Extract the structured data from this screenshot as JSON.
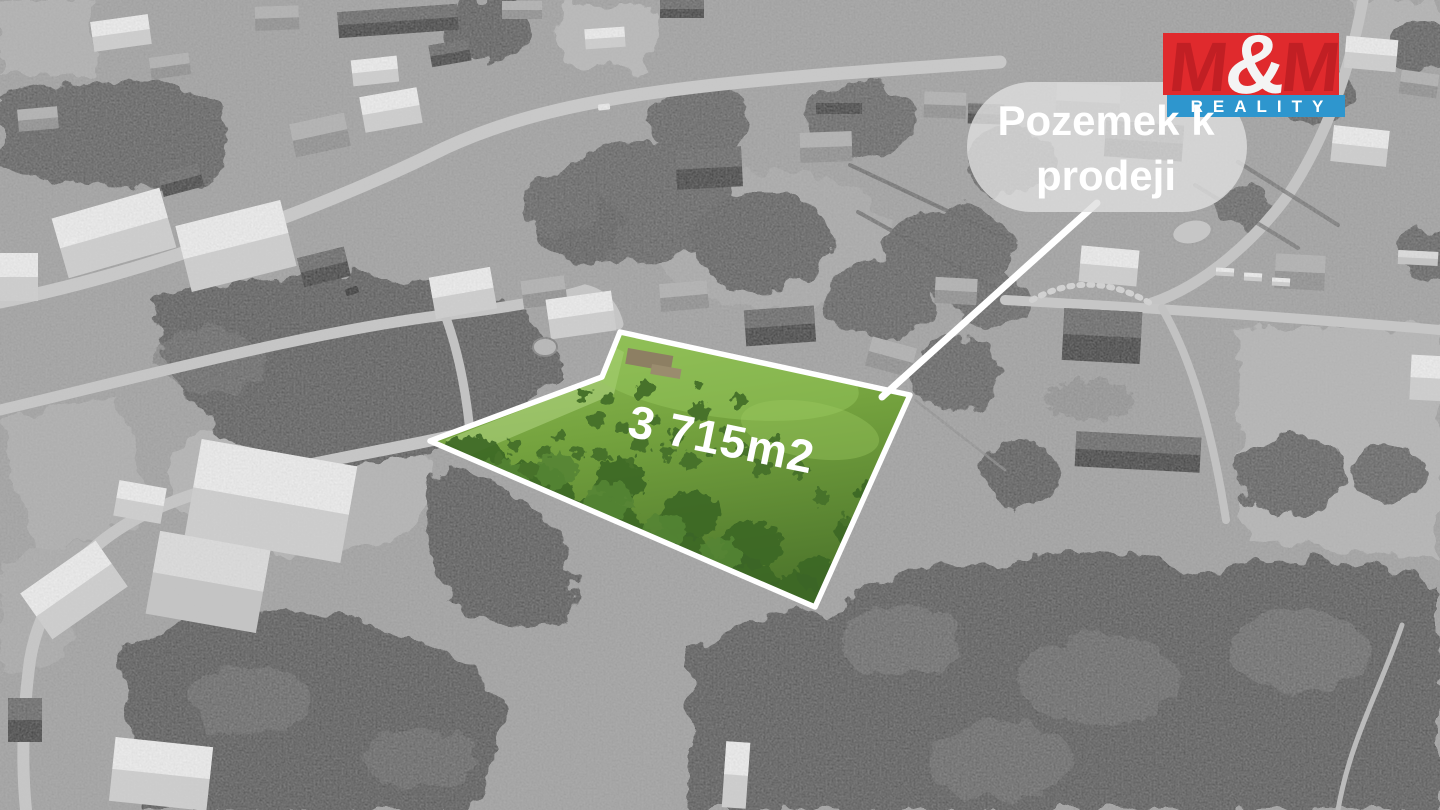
{
  "callout": {
    "line1": "Pozemek k",
    "line2": "prodeji"
  },
  "plot": {
    "area_label": "3 715m2",
    "outline_color": "#ffffff",
    "grass_green": "#74a23e"
  },
  "logo": {
    "m_left": "M",
    "ampersand": "&",
    "m_right": "M",
    "reality": "REALITY",
    "red": "#e02a2d",
    "blue": "#2e96ce"
  }
}
